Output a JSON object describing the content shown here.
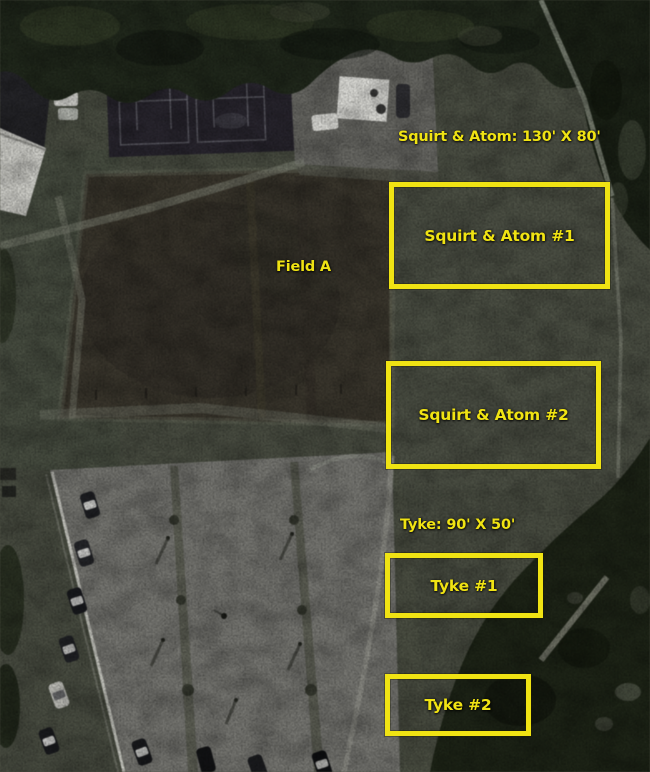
{
  "annotations": {
    "accent_color": "#f0e313",
    "size_labels": {
      "squirt_atom": "Squirt & Atom: 130' X 80'",
      "tyke": "Tyke: 90' X 50'"
    },
    "area_label": "Field A",
    "field_boxes": [
      {
        "label": "Squirt & Atom #1"
      },
      {
        "label": "Squirt & Atom #2"
      },
      {
        "label": "Tyke #1"
      },
      {
        "label": "Tyke #2"
      }
    ]
  }
}
